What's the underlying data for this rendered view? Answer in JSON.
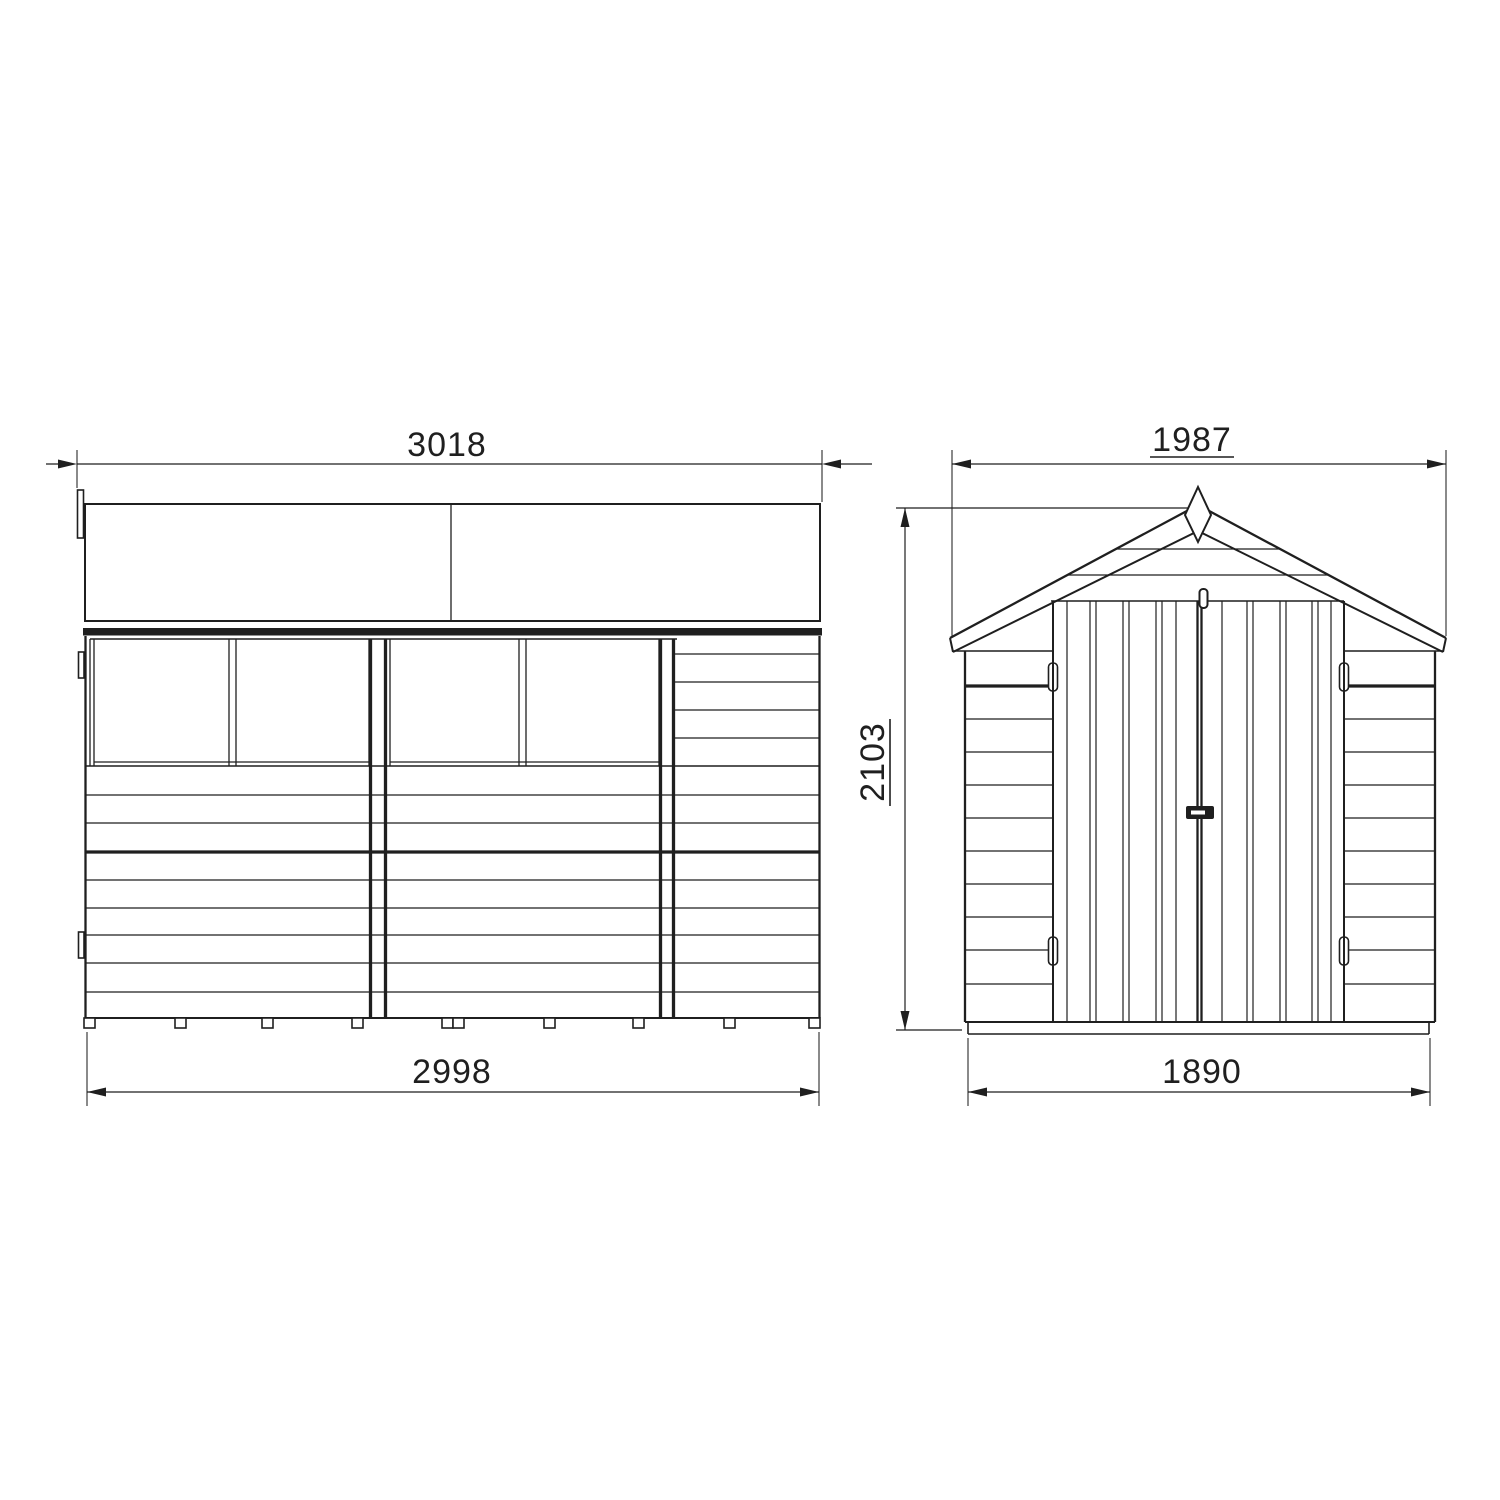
{
  "drawing": {
    "background": "#ffffff",
    "line_color": "#1f1f1f",
    "side_elevation": {
      "roof_width": "3018",
      "base_width": "2998"
    },
    "front_elevation": {
      "roof_width": "1987",
      "base_width": "1890",
      "overall_height": "2103"
    }
  }
}
